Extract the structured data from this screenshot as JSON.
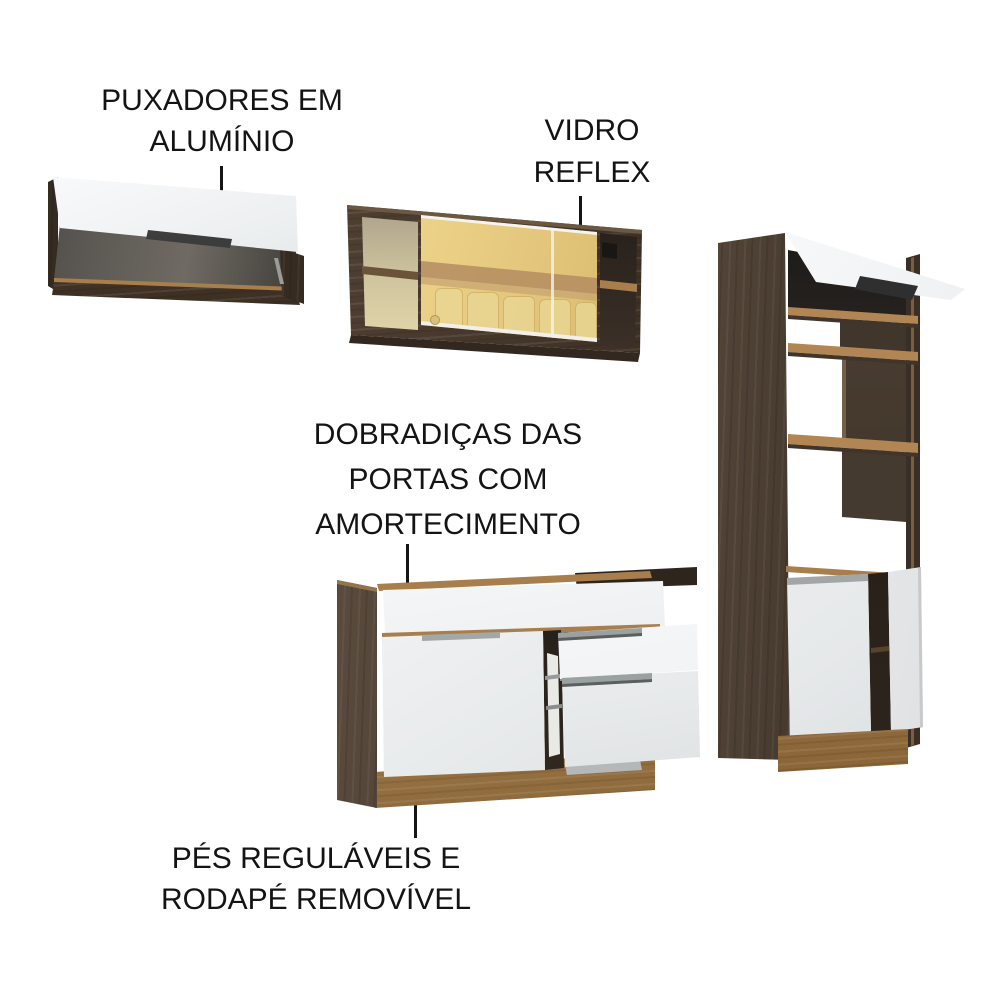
{
  "annotations": {
    "handles": {
      "lines": [
        "PUXADORES EM",
        "ALUMÍNIO"
      ]
    },
    "glass": {
      "lines": [
        "VIDRO",
        "REFLEX"
      ]
    },
    "hinges": {
      "lines": [
        "DOBRADIÇAS DAS",
        "PORTAS COM",
        "AMORTECIMENTO"
      ]
    },
    "feet": {
      "lines": [
        "PÉS REGULÁVEIS E",
        "RODAPÉ REMOVÍVEL"
      ]
    }
  },
  "palette": {
    "label_text": "#141414",
    "leader": "#151515",
    "wood_dark": "#4a3d31",
    "wood_deep": "#362b21",
    "wood_light": "#a87e4d",
    "wood_baseboard": "#9a7443",
    "door_white": "#f3f4f5",
    "door_shade": "#dde0e1",
    "interior_dark": "#44403c",
    "glass_gold": "#e9cd82",
    "glass_band": "#b48c60",
    "handle_dark": "#2f2f2f",
    "aluminum": "#9ba0a1"
  }
}
